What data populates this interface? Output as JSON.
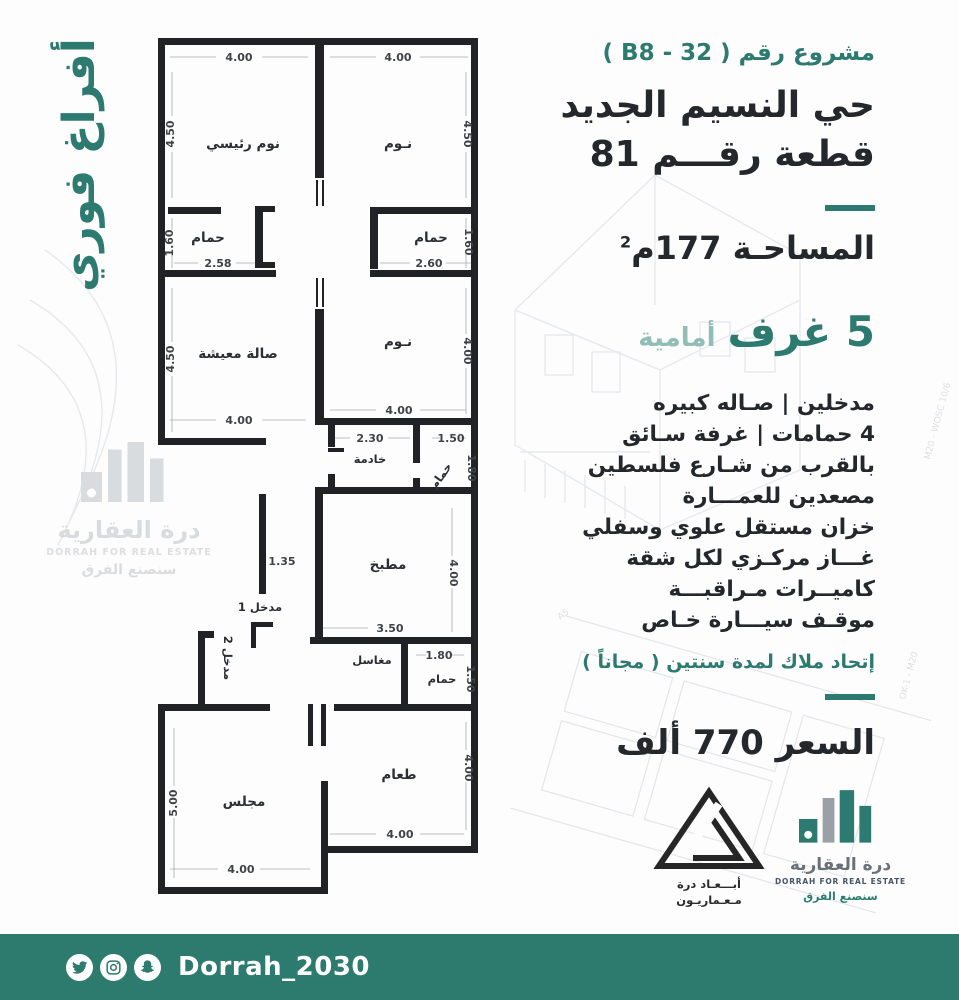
{
  "side_banner": {
    "text": "أفراغ فوري"
  },
  "right_panel": {
    "project_number": "مشروع رقم ( B8 - 32 )",
    "district": "حي النسيم الجديد",
    "plot": "قطعة رقـــم 81",
    "area_label": "المساحـة 177م",
    "area_sup": "2",
    "rooms_count": "5 غرف",
    "rooms_side": "أمامية",
    "features": [
      "مدخلين | صـاله كبيره",
      "4 حمامات | غرفة سـائق",
      "بالقرب من شـارع فلسطين",
      "مصعدين للعمـــارة",
      "خزان مستقل علوي وسفلي",
      "غـــاز مركـزي لكل شقة",
      "كاميــرات مـراقبـــة",
      "موقـف سيـــارة خـاص"
    ],
    "hoa_note": "إتحاد ملاك لمدة سنتين ( مجاناً )",
    "price": "السعر 770 ألف"
  },
  "floorplan": {
    "labels": [
      {
        "t": "نوم رئيسي",
        "x": 95,
        "y": 122,
        "c": "room"
      },
      {
        "t": "نـوم",
        "x": 250,
        "y": 122,
        "c": "room"
      },
      {
        "t": "حمام",
        "x": 60,
        "y": 216,
        "c": "room"
      },
      {
        "t": "حمام",
        "x": 283,
        "y": 216,
        "c": "room"
      },
      {
        "t": "صالة معيشة",
        "x": 90,
        "y": 332,
        "c": "room"
      },
      {
        "t": "نـوم",
        "x": 250,
        "y": 320,
        "c": "room"
      },
      {
        "t": "خادمة",
        "x": 222,
        "y": 437,
        "c": "room sm"
      },
      {
        "t": "حمام",
        "x": 296,
        "y": 452,
        "c": "room sm",
        "r": -55
      },
      {
        "t": "مطبخ",
        "x": 240,
        "y": 543,
        "c": "room"
      },
      {
        "t": "مدخل 1",
        "x": 112,
        "y": 585,
        "c": "room sm"
      },
      {
        "t": "مدخل 2",
        "x": 76,
        "y": 632,
        "c": "room sm",
        "r": 90
      },
      {
        "t": "مغاسل",
        "x": 224,
        "y": 638,
        "c": "room sm"
      },
      {
        "t": "حمام",
        "x": 294,
        "y": 657,
        "c": "room sm"
      },
      {
        "t": "مجلس",
        "x": 96,
        "y": 780,
        "c": "room"
      },
      {
        "t": "طعام",
        "x": 251,
        "y": 753,
        "c": "room"
      },
      {
        "t": "4.00",
        "x": 91,
        "y": 35,
        "c": "dim"
      },
      {
        "t": "4.00",
        "x": 250,
        "y": 35,
        "c": "dim"
      },
      {
        "t": "4.50",
        "x": 26,
        "y": 108,
        "c": "dim",
        "r": -90
      },
      {
        "t": "4.50",
        "x": 316,
        "y": 108,
        "c": "dim",
        "r": 90
      },
      {
        "t": "1.60",
        "x": 25,
        "y": 217,
        "c": "dim",
        "r": -90
      },
      {
        "t": "1.60",
        "x": 317,
        "y": 216,
        "c": "dim",
        "r": 90
      },
      {
        "t": "2.58",
        "x": 70,
        "y": 241,
        "c": "dim"
      },
      {
        "t": "2.60",
        "x": 281,
        "y": 241,
        "c": "dim"
      },
      {
        "t": "4.50",
        "x": 26,
        "y": 333,
        "c": "dim",
        "r": -90
      },
      {
        "t": "4.00",
        "x": 316,
        "y": 325,
        "c": "dim",
        "r": 90
      },
      {
        "t": "4.00",
        "x": 91,
        "y": 398,
        "c": "dim"
      },
      {
        "t": "4.00",
        "x": 251,
        "y": 388,
        "c": "dim"
      },
      {
        "t": "2.30",
        "x": 222,
        "y": 416,
        "c": "dim"
      },
      {
        "t": "1.50",
        "x": 303,
        "y": 416,
        "c": "dim"
      },
      {
        "t": "1.80",
        "x": 320,
        "y": 442,
        "c": "dim",
        "r": 90
      },
      {
        "t": "1.35",
        "x": 134,
        "y": 539,
        "c": "dim"
      },
      {
        "t": "4.00",
        "x": 302,
        "y": 547,
        "c": "dim",
        "r": 90
      },
      {
        "t": "3.50",
        "x": 242,
        "y": 606,
        "c": "dim"
      },
      {
        "t": "1.80",
        "x": 291,
        "y": 633,
        "c": "dim"
      },
      {
        "t": "1.50",
        "x": 319,
        "y": 653,
        "c": "dim",
        "r": 90
      },
      {
        "t": "5.00",
        "x": 29,
        "y": 777,
        "c": "dim",
        "r": -90
      },
      {
        "t": "4.00",
        "x": 93,
        "y": 847,
        "c": "dim"
      },
      {
        "t": "4.00",
        "x": 317,
        "y": 742,
        "c": "dim",
        "r": 90
      },
      {
        "t": "4.00",
        "x": 252,
        "y": 812,
        "c": "dim"
      }
    ]
  },
  "watermark_logo": {
    "title": "درة العقارية",
    "subtitle": "DORRAH FOR REAL ESTATE",
    "tagline": "سنصنع الفرق"
  },
  "architect_logo": {
    "line1": "أبـــعـاد درة",
    "line2": "مـعـماريـون"
  },
  "brand_logo": {
    "title": "درة العقارية",
    "subtitle": "DORRAH FOR REAL ESTATE",
    "tagline": "سنصنع الفرق"
  },
  "footer": {
    "handle": "Dorrah_2030",
    "icons": [
      "twitter-icon",
      "instagram-icon",
      "snapchat-icon"
    ]
  },
  "colors": {
    "teal": "#2d7b70",
    "teal_light": "#92bdb5",
    "dark_text": "#24272c",
    "footer_bg": "#2d7a6e",
    "wall": "#202225",
    "watermark_gray": "#d9dcdf"
  }
}
